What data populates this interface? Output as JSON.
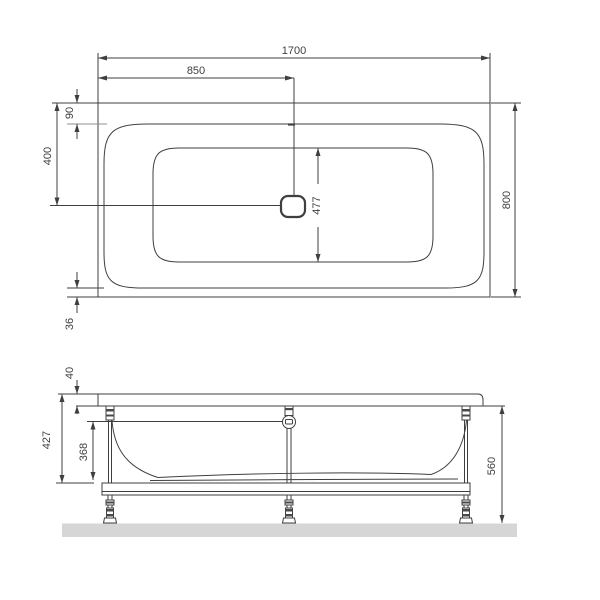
{
  "colors": {
    "line": "#3f3f3f",
    "text": "#3f3f3f",
    "floor": "#d6d6d6",
    "hardware_fill": "#4a4a4a",
    "background": "#ffffff"
  },
  "top_view": {
    "length_total": "1700",
    "length_to_drain": "850",
    "rim_front_offset": "90",
    "drain_offset": "400",
    "basin_width": "477",
    "width_total": "800",
    "rim_back_offset": "36"
  },
  "front_view": {
    "rim_thickness": "40",
    "body_height": "427",
    "basin_depth": "368",
    "height_total": "560"
  }
}
